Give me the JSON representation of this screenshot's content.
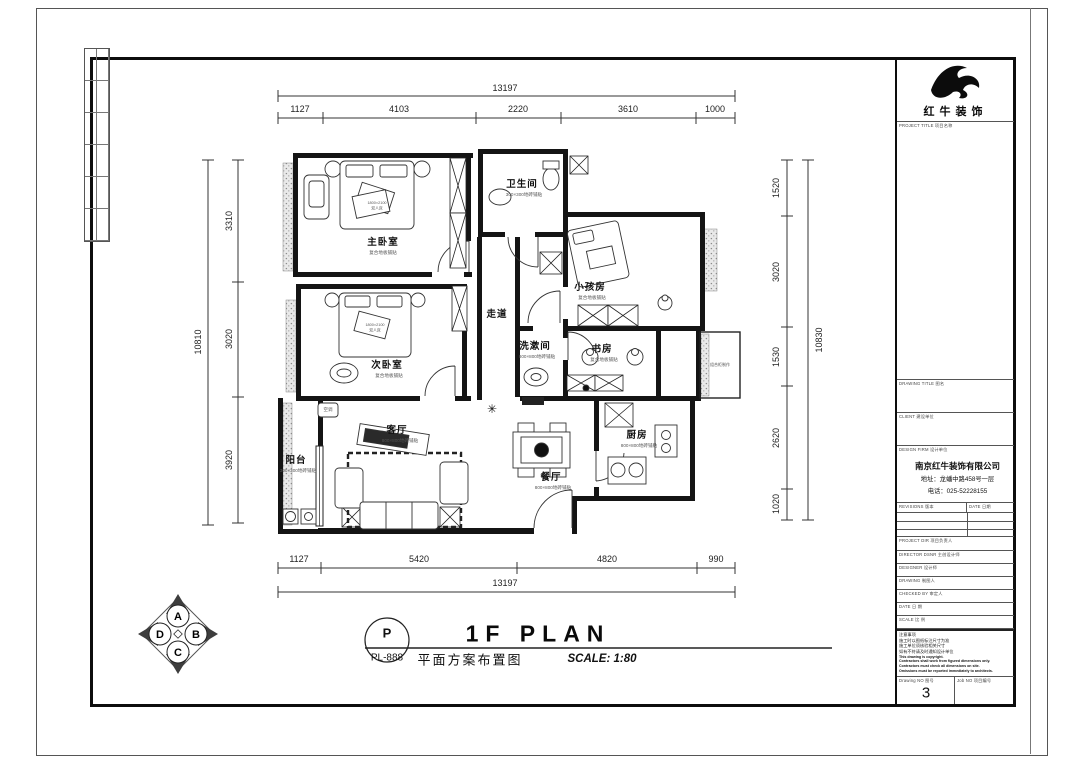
{
  "company": {
    "logo_text": "红牛装饰"
  },
  "titleblock": {
    "project_title": "PROJECT TITLE  项目名称",
    "drawing_title": "DRAWING TITLE  图名",
    "client": "CLIENT  建设单位",
    "design_firm": "DESIGN FIRM  设计单位",
    "firm_name": "南京红牛装饰有限公司",
    "firm_address": "地址：龙蟠中路458号一层",
    "firm_phone": "电话：025-52228155",
    "revisions": "REVISIONS  版本",
    "rev_date": "DATE 日期",
    "project_dir": "PROJECT DIR  项目负责人",
    "director": "DIRECTOR DSNR  主创设计师",
    "designer": "DESIGNER  设计师",
    "drawing": "DRAWING  制图人",
    "checked": "CHECKED BY  审定人",
    "date_row": "DATE  日 期",
    "scale_row": "SCALE  比 例",
    "notes": [
      "注意事项",
      "施工时以图纸标注尺寸为准",
      "施工单位须核验相关尺寸",
      "如有不符请及时通知设计单位",
      "This drawing is copyright.",
      "Contractors shall work from figured dimensions only.",
      "Contractors must check all dimensions on site.",
      "Omissions must be reported immediately to architects."
    ],
    "drawing_no_label": "Drawing NO  图号",
    "drawing_no": "3",
    "job_no_label": "Job NO  项目编号"
  },
  "footer": {
    "symbol": "P",
    "sheet_code": "PL-888",
    "title_en": "1F PLAN",
    "title_cn": "平面方案布置图",
    "scale": "SCALE:  1:80"
  },
  "compass": {
    "top": "A",
    "right": "B",
    "bottom": "C",
    "left": "D"
  },
  "dims": {
    "top": {
      "total": "13197",
      "segments": [
        "1127",
        "4103",
        "2220",
        "3610",
        "1000"
      ]
    },
    "bottom": {
      "total": "13197",
      "segments": [
        "1127",
        "5420",
        "4820",
        "990"
      ]
    },
    "left": {
      "total": "10810",
      "segments": [
        "3310",
        "3020",
        "3920"
      ]
    },
    "right": {
      "total": "10830",
      "segments": [
        "1520",
        "3020",
        "1530",
        "2620",
        "1020"
      ]
    }
  },
  "rooms": [
    {
      "name": "主卧室",
      "finish": "复合地板铺贴"
    },
    {
      "name": "次卧室",
      "finish": "复合地板铺贴"
    },
    {
      "name": "小孩房",
      "finish": "复合地板铺贴"
    },
    {
      "name": "书房",
      "finish": "复合地板铺贴"
    },
    {
      "name": "卫生间",
      "finish": "300×300地砖铺贴"
    },
    {
      "name": "洗漱间",
      "finish": "800×800地砖铺贴"
    },
    {
      "name": "客厅",
      "finish": "800×800地砖铺贴"
    },
    {
      "name": "餐厅",
      "finish": "800×800地砖铺贴"
    },
    {
      "name": "厨房",
      "finish": "800×800地砖铺贴"
    },
    {
      "name": "阳台",
      "finish": "300×300地砖铺贴"
    },
    {
      "name": "走道",
      "finish": ""
    }
  ],
  "annotations": {
    "ac": "空调",
    "cabinet": "组合柜制作",
    "bed_size": "1800×2100",
    "bed_type": "双人床",
    "plant": "✳"
  }
}
